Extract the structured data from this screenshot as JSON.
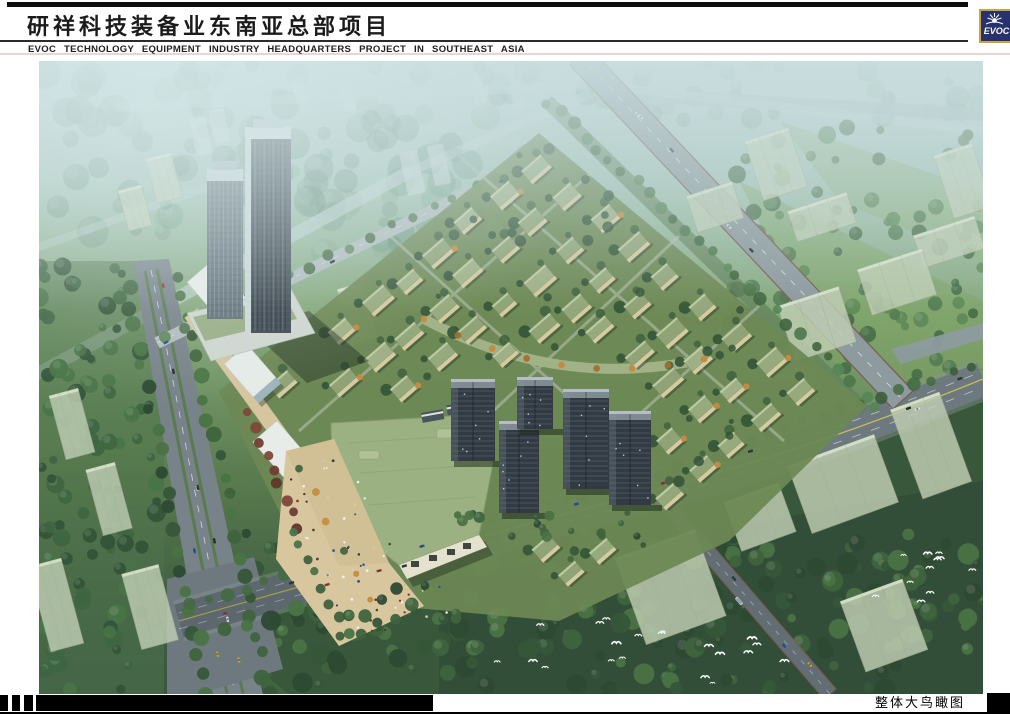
{
  "header": {
    "title_zh": "研祥科技装备业东南亚总部项目",
    "subtitle_en": "EVOC TECHNOLOGY EQUIPMENT INDUSTRY HEADQUARTERS PROJECT IN SOUTHEAST ASIA"
  },
  "logo": {
    "brand": "EVOC"
  },
  "footer": {
    "caption": "整体大鸟瞰图"
  },
  "render": {
    "palette": {
      "haze_top": "#bdd3d6",
      "haze_green": "#9fbfae",
      "grass_mid": "#7ea06c",
      "forest_dark": "#2f4f31",
      "road_grey": "#6b757c",
      "road_light": "#8d989d",
      "road_edge_brown": "#7a544a",
      "lane_yellow": "#d6c64a",
      "villa_roof": "#97a97a",
      "villa_wall": "#d9cb9f",
      "plaza_tan": "#dcc89d",
      "mall_roof": "#9db17f",
      "tower_glass_dark": "#39434d",
      "tower_glass_light": "#5f6c76",
      "res_tower_dark": "#2c343c",
      "ghost_building": "#c3d0b4",
      "logo_navy": "#27316f",
      "logo_gold": "#c9a53b"
    }
  }
}
